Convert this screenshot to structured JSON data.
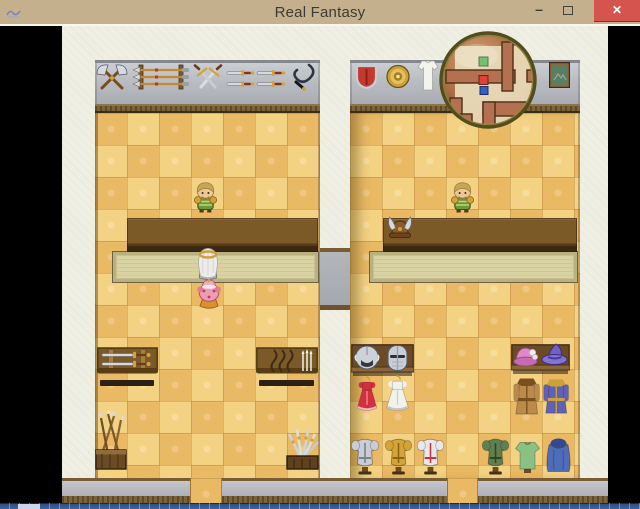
{
  "window": {
    "title": "Real Fantasy",
    "controls": {
      "minimize_glyph": "–",
      "close_glyph": "✕"
    }
  },
  "game": {
    "minimap": {
      "dot_colors": {
        "npc_green": "#52b44e",
        "event_red": "#e04038",
        "player_blue": "#2f62c4"
      }
    },
    "palette": {
      "titlebar_tan": "#c4b08c",
      "close_red": "#d5544e",
      "wall_beige": "#f0efe3",
      "wall_gray": "#b9bcc2",
      "trim_brown": "#7d6339",
      "tile_light": "#f4d284",
      "tile_dark": "#e9b963",
      "counter_brown": "#7c5a28",
      "mat_khaki": "#d9d3a4",
      "taskbar_blue": "#3f66a4"
    },
    "items": [
      {
        "name": "weapon-axes-display",
        "type": "axes",
        "x": 33,
        "y": 36,
        "w": 34,
        "h": 30,
        "interactable": false
      },
      {
        "name": "weapon-spear-rack",
        "type": "spears",
        "x": 71,
        "y": 37,
        "w": 58,
        "h": 28,
        "interactable": false
      },
      {
        "name": "weapon-crossed-swords",
        "type": "crossedswords",
        "x": 131,
        "y": 37,
        "w": 30,
        "h": 30,
        "interactable": false
      },
      {
        "name": "weapon-daggers-a",
        "type": "daggers",
        "x": 163,
        "y": 39,
        "w": 31,
        "h": 26,
        "interactable": false
      },
      {
        "name": "weapon-daggers-b",
        "type": "daggers",
        "x": 193,
        "y": 39,
        "w": 32,
        "h": 26,
        "interactable": false
      },
      {
        "name": "weapon-whip",
        "type": "whip",
        "x": 226,
        "y": 36,
        "w": 29,
        "h": 30,
        "interactable": false
      },
      {
        "name": "shield-red",
        "type": "shield",
        "x": 293,
        "y": 37,
        "w": 23,
        "h": 27,
        "interactable": false
      },
      {
        "name": "shield-buckler",
        "type": "buckler",
        "x": 324,
        "y": 38,
        "w": 24,
        "h": 25,
        "interactable": false
      },
      {
        "name": "garment-white-display",
        "type": "garment",
        "x": 355,
        "y": 33,
        "w": 22,
        "h": 34,
        "interactable": false
      },
      {
        "name": "picture-frame",
        "type": "picture",
        "x": 487,
        "y": 36,
        "w": 21,
        "h": 26,
        "interactable": false
      },
      {
        "name": "helmet-horned-counter",
        "type": "hornhelm",
        "x": 324,
        "y": 189,
        "w": 28,
        "h": 26,
        "interactable": false,
        "z": 4
      },
      {
        "name": "player-hero-left",
        "type": "hero",
        "x": 131,
        "y": 154,
        "w": 25,
        "h": 33,
        "interactable": true,
        "z": 5
      },
      {
        "name": "player-hero-right",
        "type": "hero",
        "x": 388,
        "y": 154,
        "w": 25,
        "h": 33,
        "interactable": true,
        "z": 5
      },
      {
        "name": "npc-shopkeeper",
        "type": "elder",
        "x": 133,
        "y": 219,
        "w": 26,
        "h": 35,
        "interactable": true,
        "z": 5
      },
      {
        "name": "npc-princess",
        "type": "princess",
        "x": 134,
        "y": 252,
        "w": 26,
        "h": 31,
        "interactable": true,
        "z": 5
      },
      {
        "name": "table-swords",
        "type": "tableswords",
        "x": 35,
        "y": 320,
        "w": 61,
        "h": 42,
        "interactable": false
      },
      {
        "name": "table-bows",
        "type": "tablebows",
        "x": 194,
        "y": 320,
        "w": 62,
        "h": 42,
        "interactable": false
      },
      {
        "name": "rack-spear-quiver",
        "type": "quiver",
        "x": 32,
        "y": 384,
        "w": 34,
        "h": 62,
        "interactable": false
      },
      {
        "name": "rack-sword-pile",
        "type": "swordpile",
        "x": 222,
        "y": 400,
        "w": 37,
        "h": 46,
        "interactable": false
      },
      {
        "name": "shelf-helmets",
        "type": "shelf",
        "x": 289,
        "y": 318,
        "w": 63,
        "h": 32,
        "interactable": false,
        "z": 2
      },
      {
        "name": "helmet-winged",
        "type": "helmround",
        "x": 291,
        "y": 318,
        "w": 28,
        "h": 28,
        "interactable": false
      },
      {
        "name": "helmet-great",
        "type": "helmgreat",
        "x": 321,
        "y": 317,
        "w": 29,
        "h": 30,
        "interactable": false
      },
      {
        "name": "dress-red",
        "type": "dress",
        "x": 292,
        "y": 350,
        "w": 26,
        "h": 36,
        "interactable": false,
        "c": "#d2303e",
        "c2": "#f2b6bc"
      },
      {
        "name": "dress-white",
        "type": "dress",
        "x": 321,
        "y": 349,
        "w": 29,
        "h": 37,
        "interactable": false,
        "c": "#f2f2ec",
        "c2": "#c4c4cc"
      },
      {
        "name": "shelf-hats",
        "type": "shelf",
        "x": 449,
        "y": 318,
        "w": 59,
        "h": 30,
        "interactable": false,
        "z": 2
      },
      {
        "name": "hat-pink",
        "type": "hatpink",
        "x": 451,
        "y": 318,
        "w": 25,
        "h": 26,
        "interactable": false
      },
      {
        "name": "hat-wizard",
        "type": "hatwiz",
        "x": 479,
        "y": 316,
        "w": 28,
        "h": 28,
        "interactable": false
      },
      {
        "name": "coat-brown",
        "type": "coat",
        "x": 450,
        "y": 349,
        "w": 29,
        "h": 43,
        "interactable": false,
        "c": "#bd8a4e",
        "c2": "#7a501e"
      },
      {
        "name": "robe-blue",
        "type": "coat",
        "x": 480,
        "y": 350,
        "w": 28,
        "h": 41,
        "interactable": false,
        "c": "#6060b4",
        "c2": "#caa23c"
      },
      {
        "name": "armor-stand-silver",
        "type": "armor",
        "x": 288,
        "y": 410,
        "w": 30,
        "h": 39,
        "interactable": false,
        "c": "#c9cdd6",
        "c2": "#7a808c"
      },
      {
        "name": "armor-stand-gold",
        "type": "armor",
        "x": 322,
        "y": 410,
        "w": 29,
        "h": 39,
        "interactable": false,
        "c": "#d4a437",
        "c2": "#8a6414"
      },
      {
        "name": "armor-stand-white-red",
        "type": "armor",
        "x": 354,
        "y": 410,
        "w": 29,
        "h": 39,
        "interactable": false,
        "c": "#e8e8e8",
        "c2": "#cc3340"
      },
      {
        "name": "armor-stand-green",
        "type": "armor",
        "x": 419,
        "y": 410,
        "w": 29,
        "h": 39,
        "interactable": false,
        "c": "#5f8052",
        "c2": "#31481f"
      },
      {
        "name": "tunic-green",
        "type": "tunic",
        "x": 452,
        "y": 412,
        "w": 27,
        "h": 37,
        "interactable": false,
        "c": "#8cc083",
        "c2": "#4a7a42"
      },
      {
        "name": "cloak-blue",
        "type": "cloak",
        "x": 482,
        "y": 410,
        "w": 29,
        "h": 39,
        "interactable": false,
        "c": "#4f6cb8",
        "c2": "#35488c"
      },
      {
        "name": "minimap-overlay",
        "type": "minimap",
        "x": 376,
        "y": 4,
        "w": 100,
        "h": 100,
        "interactable": false,
        "z": 9
      }
    ]
  }
}
